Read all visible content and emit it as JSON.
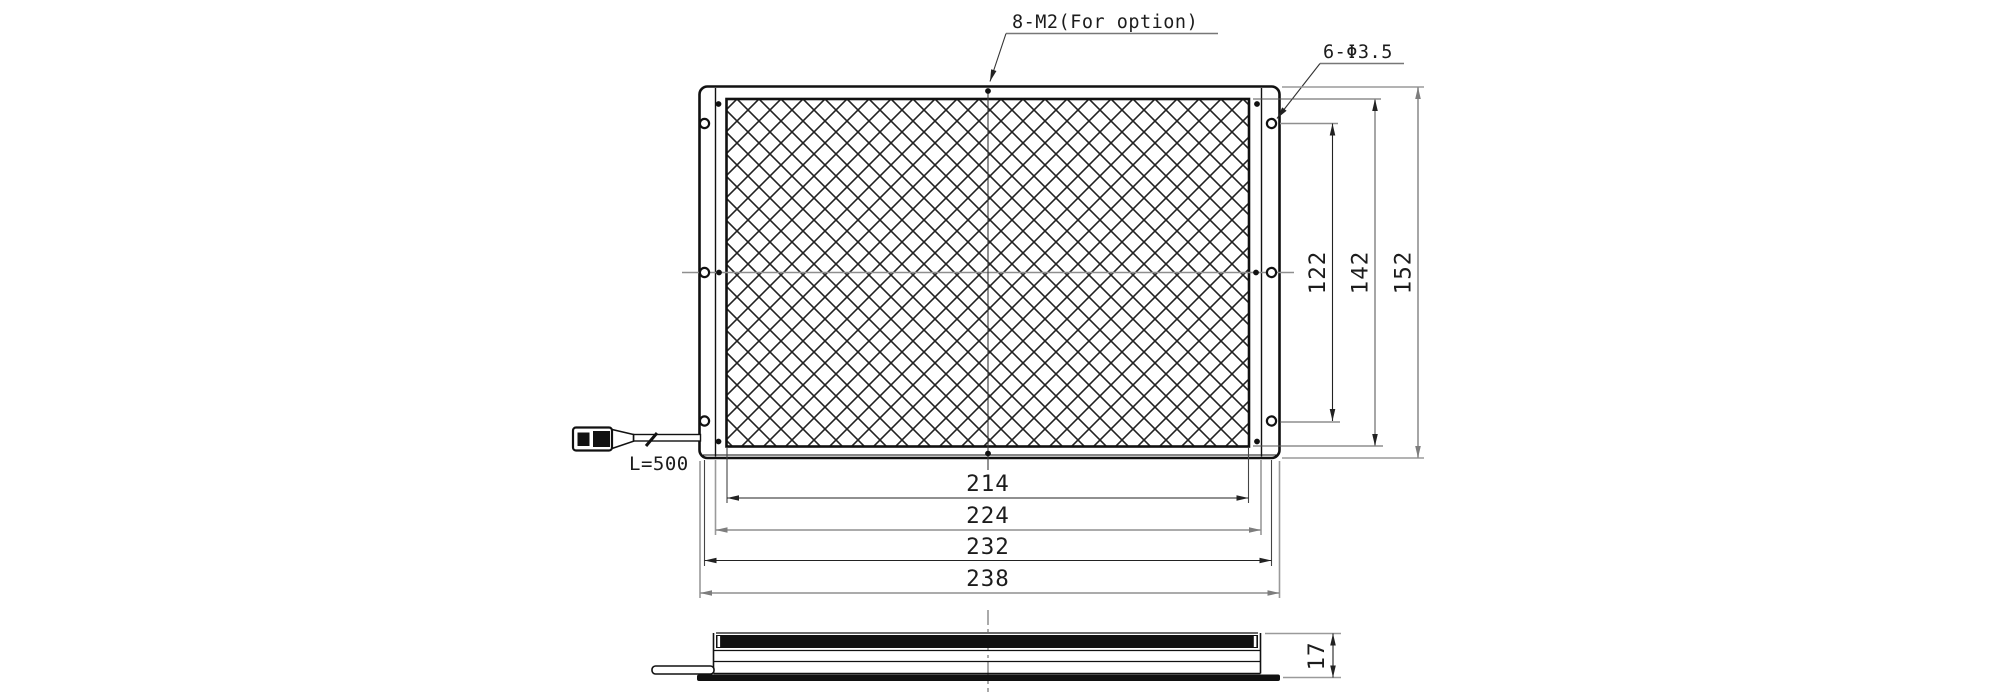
{
  "labels": {
    "screw_callout": "8-M2(For option)",
    "hole_callout": "6-Φ3.5",
    "cable_length": "L=500"
  },
  "dimensions": {
    "horizontal": {
      "emitting_width": "214",
      "body_width": "224",
      "hole_pitch_width": "232",
      "overall_width": "238"
    },
    "vertical": {
      "hole_pitch_height": "122",
      "emitting_height": "142",
      "overall_height": "152"
    },
    "side": {
      "thickness": "17"
    }
  },
  "colors": {
    "background": "#ffffff",
    "line": "#1a1a1a",
    "dim": "#3a3a3a",
    "extension": "#8f8f8f"
  }
}
